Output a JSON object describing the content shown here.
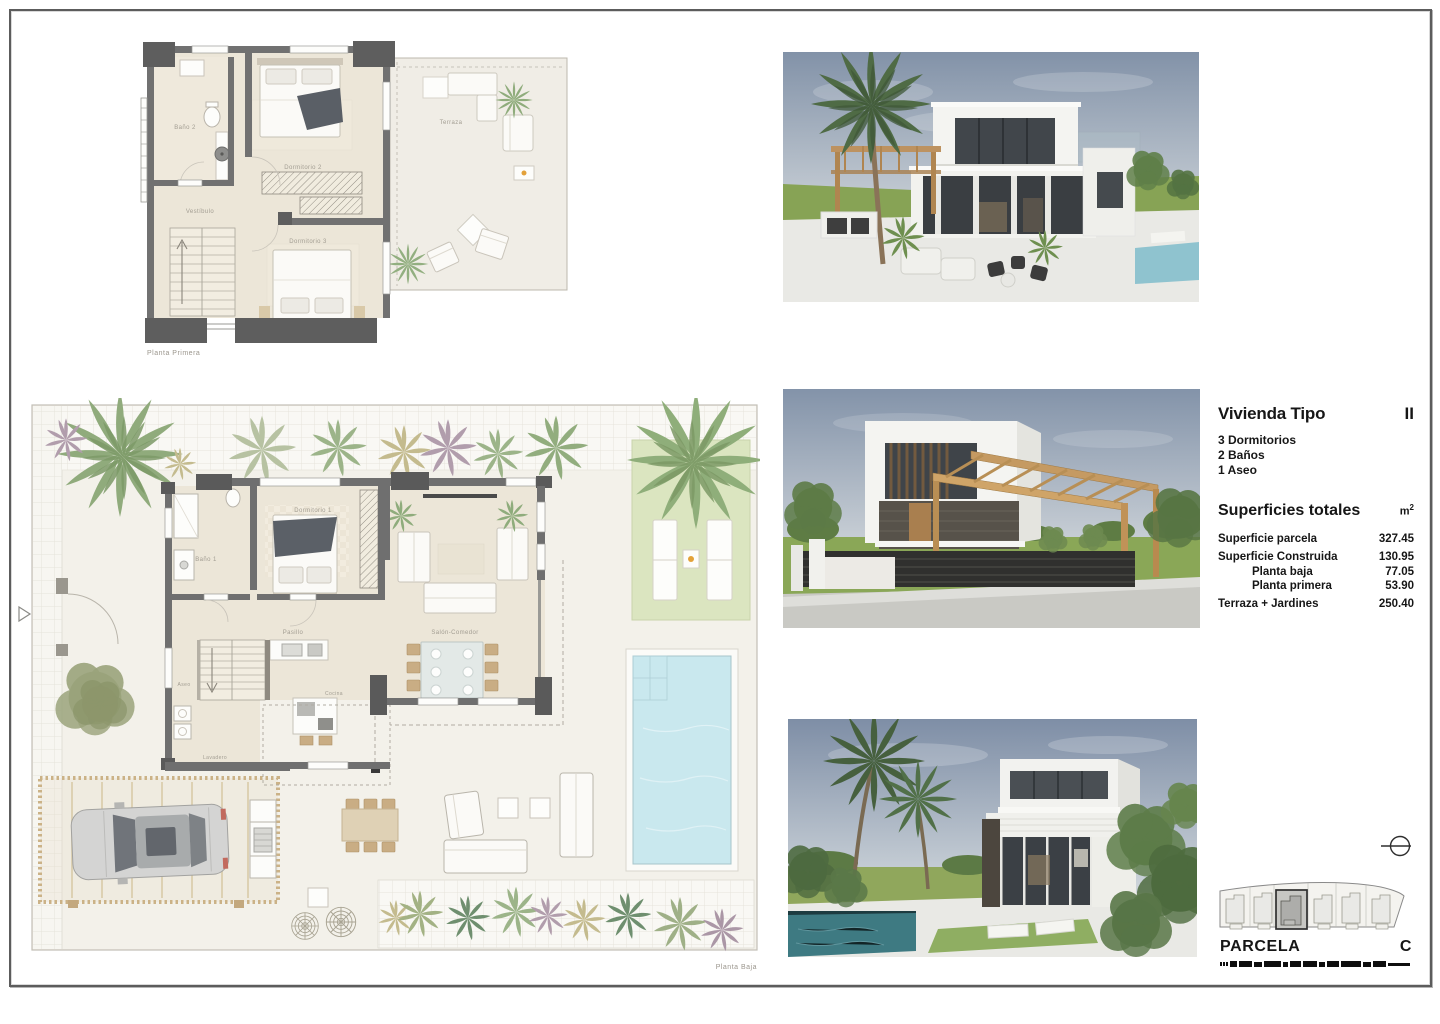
{
  "plans": {
    "planta_primera": {
      "caption": "Planta Primera",
      "rooms": {
        "bano2": "Baño 2",
        "vestibulo": "Vestíbulo",
        "dormitorio2": "Dormitorio 2",
        "dormitorio3": "Dormitorio 3",
        "terraza": "Terraza"
      }
    },
    "planta_baja": {
      "caption": "Planta Baja",
      "rooms": {
        "bano1": "Baño 1",
        "dormitorio1": "Dormitorio 1",
        "pasillo": "Pasillo",
        "salon_comedor": "Salón-Comedor",
        "cocina": "Cocina",
        "aseo": "Aseo",
        "lavadero": "Lavadero"
      }
    }
  },
  "info": {
    "title": "Vivienda Tipo",
    "type_code": "II",
    "features": [
      "3 Dormitorios",
      "2 Baños",
      "1 Aseo"
    ],
    "totals_heading": "Superficies totales",
    "unit": "m",
    "unit_sup": "2",
    "rows": [
      {
        "label": "Superficie parcela",
        "value": "327.45",
        "indent": false
      },
      {
        "label": "Superficie Construida",
        "value": "130.95",
        "indent": false
      },
      {
        "label": "Planta baja",
        "value": "77.05",
        "indent": true
      },
      {
        "label": "Planta primera",
        "value": "53.90",
        "indent": true
      },
      {
        "label": "Terraza + Jardines",
        "value": "250.40",
        "indent": false
      }
    ]
  },
  "parcela": {
    "label": "PARCELA",
    "code": "C"
  },
  "colors": {
    "ink": "#161616",
    "plan_label": "#a29d92",
    "wall": "#6f6f6f",
    "pool_water": "#c9e8ee",
    "lawn": "#dbe5c0",
    "wood": "#c59a62",
    "accent_dot": "#e3a13a"
  }
}
